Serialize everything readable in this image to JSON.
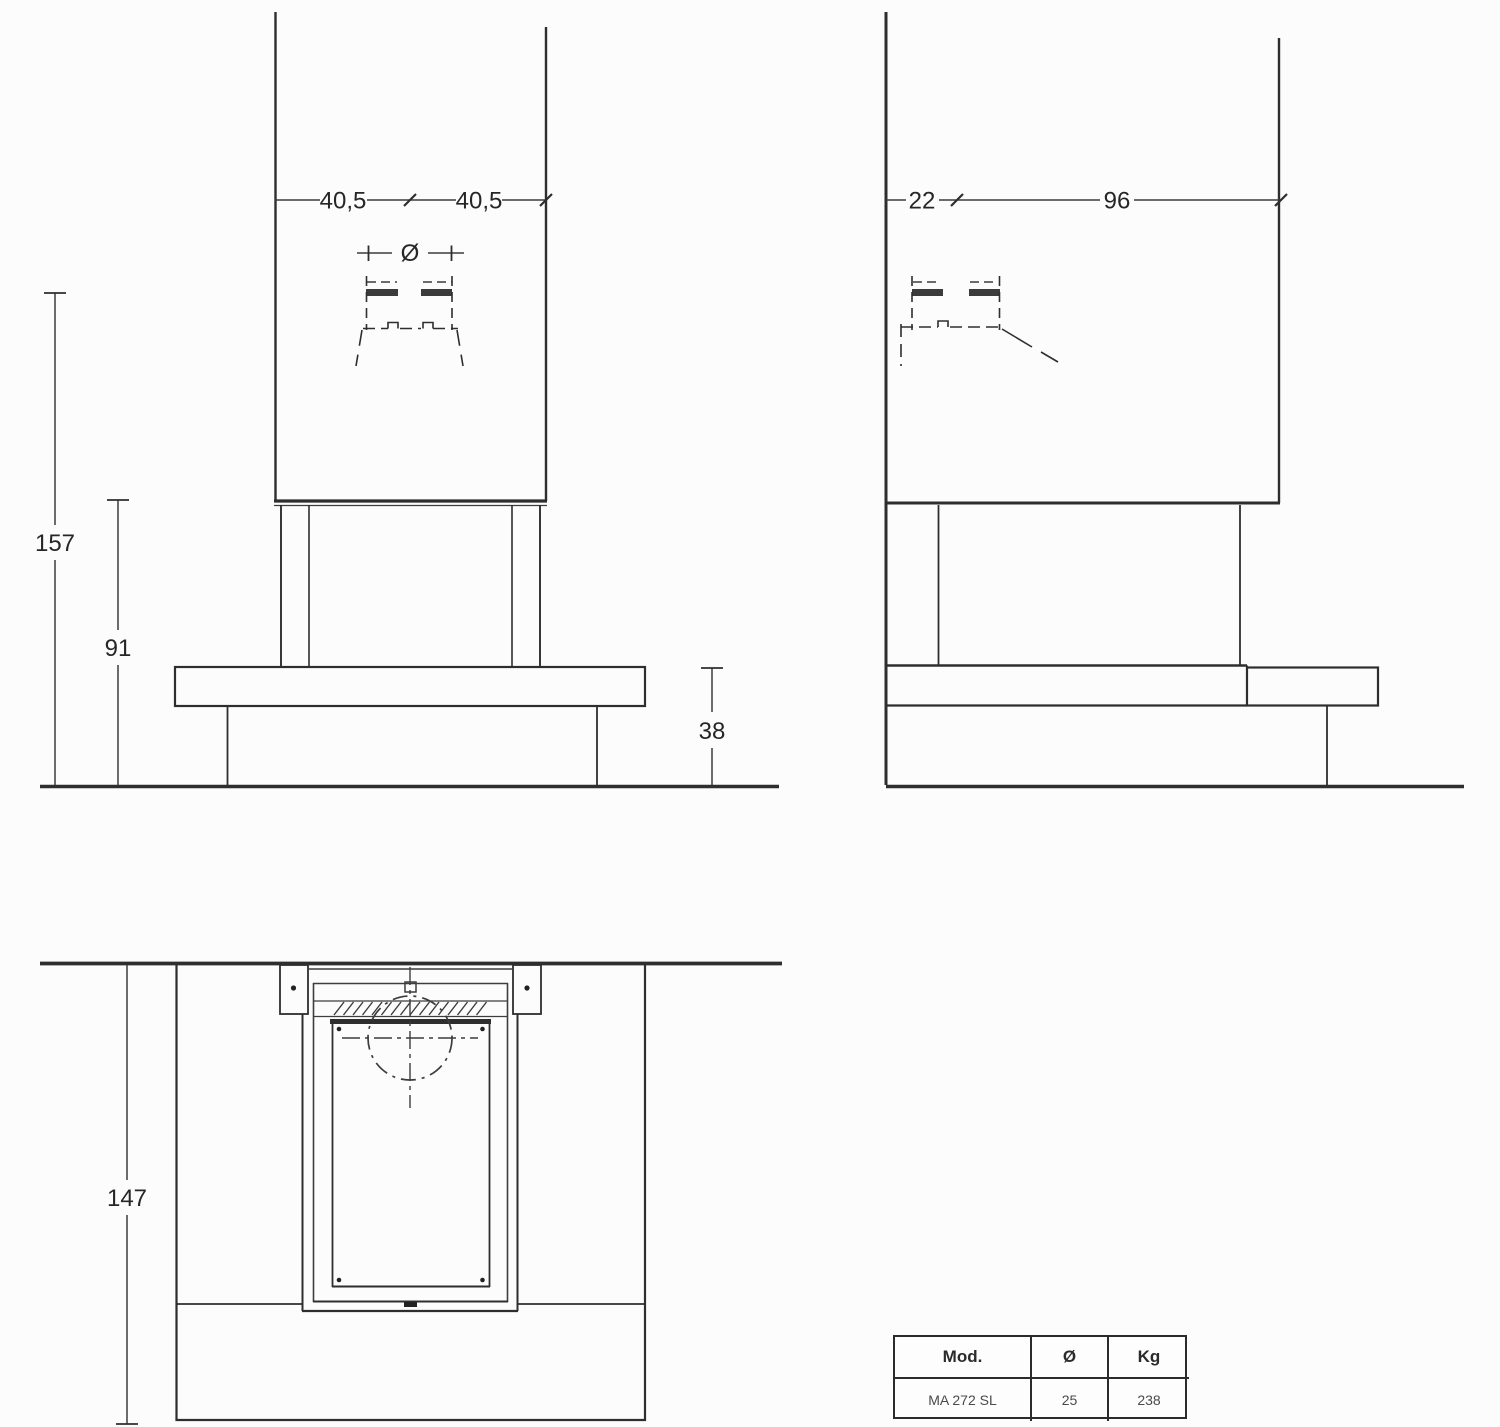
{
  "drawing": {
    "front_view": {
      "dim_width_left": "40,5",
      "dim_width_right": "40,5",
      "flue_diameter_symbol": "Ø",
      "dim_height_flue": "157",
      "dim_height_hood": "91",
      "dim_height_bench": "38"
    },
    "side_view": {
      "dim_depth_hood": "22",
      "dim_depth_total": "96"
    },
    "plan_view": {
      "dim_width_total": "147"
    },
    "colors": {
      "line": "#2e2e2e",
      "background": "#fcfcfc"
    }
  },
  "spec_table": {
    "headers": {
      "model": "Mod.",
      "diameter": "Ø",
      "weight": "Kg"
    },
    "rows": [
      {
        "model": "MA 272 SL",
        "diameter": "25",
        "weight": "238"
      }
    ]
  }
}
